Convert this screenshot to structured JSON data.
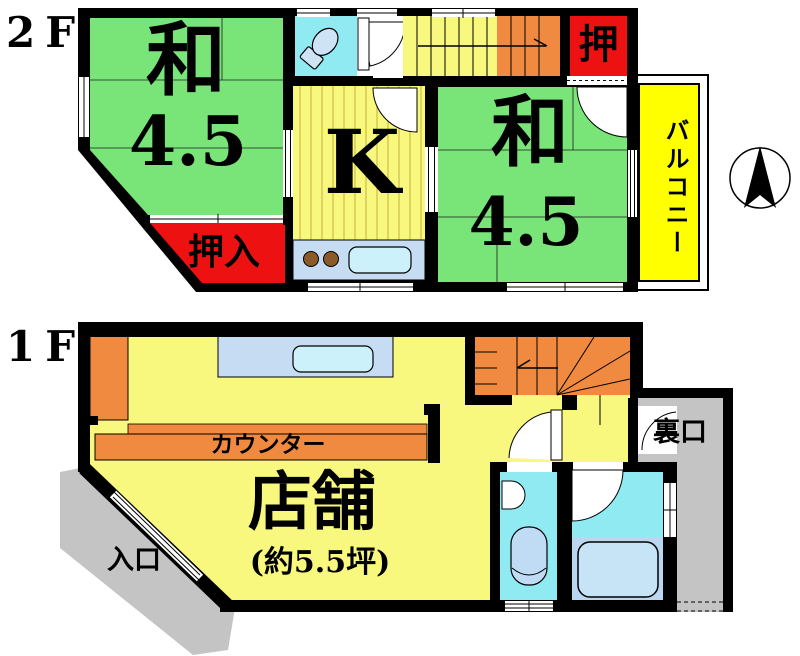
{
  "floor2": {
    "label": "2F",
    "room_left_name": "和",
    "room_left_size": "4.5",
    "kitchen_label": "K",
    "room_right_name": "和",
    "room_right_size": "4.5",
    "closet_small_label": "押",
    "closet_label": "押入",
    "balcony_label": "バルコニー"
  },
  "floor1": {
    "label": "1F",
    "shop_label": "店舗",
    "shop_area": "(約5.5坪)",
    "counter_label": "カウンター",
    "entrance_label": "入口",
    "back_entrance_label": "裏口"
  },
  "icons": {
    "compass": "north-arrow-compass",
    "toilet_2f": "toilet-icon",
    "toilet_1f": "toilet-icon",
    "bathtub_1f": "bathtub-icon",
    "sink_kitchen": "sink-icon",
    "burners_kitchen": "stove-burners-icon"
  },
  "colors": {
    "wall": "#000000",
    "tatami_green": "#79E579",
    "room_yellow": "#F8F87E",
    "closet_red": "#EE1111",
    "stair_orange": "#F08A40",
    "water_cyan": "#8FEAF2",
    "fixture_blue": "#C5DCF2",
    "sink_blue": "#CDF1FA",
    "bath_blue": "#BBD7F0",
    "bathtub_blue": "#C6E4F6",
    "balcony_yellow": "#FFFF00",
    "outside_gray": "#C4C4C4"
  }
}
